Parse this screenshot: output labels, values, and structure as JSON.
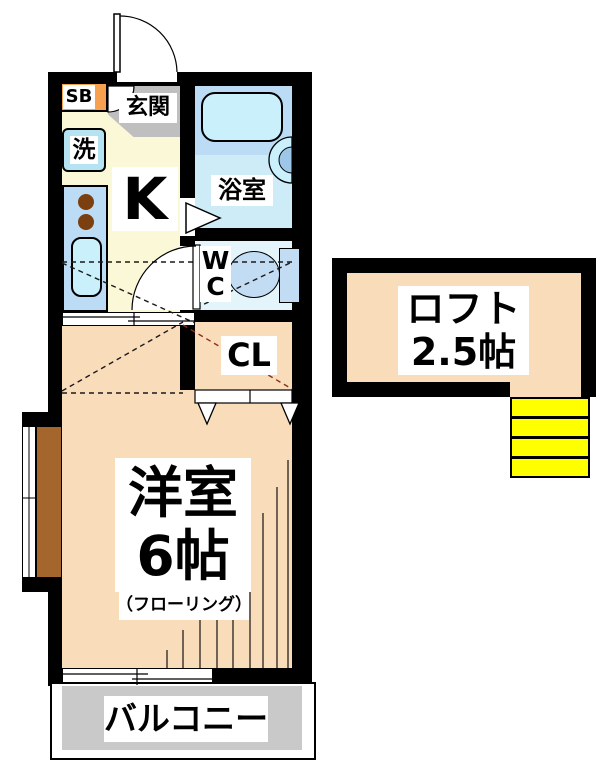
{
  "title": "apartment-floor-plan",
  "rooms": {
    "shoe_box": {
      "label": "SB"
    },
    "washer": {
      "label": "洗"
    },
    "genkan": {
      "label": "玄関"
    },
    "kitchen": {
      "label": "K"
    },
    "bathroom": {
      "label": "浴室"
    },
    "wc": {
      "label_top": "W",
      "label_bottom": "C"
    },
    "closet": {
      "label": "CL"
    },
    "western_room": {
      "name": "洋室",
      "size": "6帖",
      "flooring_note": "（フローリング）"
    },
    "loft": {
      "name": "ロフト",
      "size": "2.5帖"
    },
    "balcony": {
      "label": "バルコニー"
    }
  },
  "colors": {
    "wall": "#000000",
    "room_peach": "#F9DCBA",
    "closet_orange": "#F5A14F",
    "kitchen_yellow": "#FBF8D8",
    "genkan_gray": "#BFBFBF",
    "balcony_gray": "#C9C9C9",
    "bath_blue": "#CDECF8",
    "tub_band_blue": "#BCDCF5",
    "wc_blue": "#E3F5FB",
    "fixture_blue": "#C2DCF4",
    "water_blue": "#C9F0FB",
    "washer_blue": "#B5E3F2",
    "stairs_yellow": "#FFFF00",
    "ledge_brown": "#A5662D",
    "burner_brown": "#7B3F10",
    "loft_dash_red": "#8B3020"
  }
}
